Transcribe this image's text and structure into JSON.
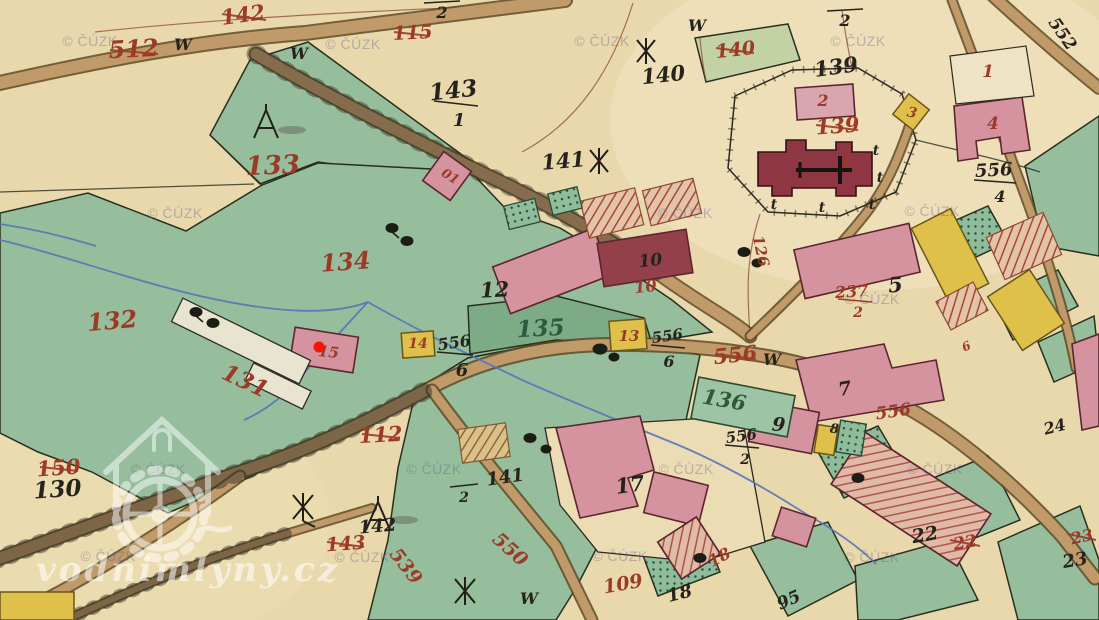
{
  "watermarks": {
    "cuzk": "© ČÚZK",
    "site": "vodnimlyny.cz"
  },
  "marker": {
    "color": "#ff1100",
    "meaning": "selected water mill location"
  },
  "palette": {
    "paper": "#e8d8ab",
    "meadow_green": "#96bd9c",
    "building_pink": "#d4939e",
    "building_yellow": "#dec04a",
    "church_red": "#8e3742",
    "road_tan": "#c09a69",
    "stream_blue": "#5377b8",
    "old_number_red": "#9c3a28",
    "number_black": "#26231c"
  },
  "labels": {
    "parcel_512": "512",
    "parcel_142_old": "142",
    "parcel_115": "115",
    "parcel_140_old": "140",
    "parcel_139_old": "139",
    "parcel_133": "133",
    "parcel_134": "134",
    "parcel_132": "132",
    "parcel_131": "131",
    "parcel_150": "150",
    "parcel_130": "130",
    "parcel_112": "112",
    "parcel_143_old": "143",
    "road_539": "539",
    "road_550": "550",
    "road_556_struck": "556",
    "parcel_556_red": "556",
    "parcel_109": "109",
    "house_18_red": "18",
    "parcel_22_red": "22",
    "parcel_23_red": "23",
    "frac_237_num": "237",
    "frac_237_den": "2",
    "parcel_126": "126",
    "house_10_red": "10",
    "house_01": "01",
    "house_1": "1",
    "house_2": "2",
    "house_3": "3",
    "house_4": "4",
    "house_13": "13",
    "house_14": "14",
    "house_15": "15",
    "church_1": "1",
    "small_6_red": "6",
    "frac_143_num": "143",
    "frac_143_den": "1",
    "parcel_140": "140",
    "parcel_141": "141",
    "parcel_139": "139",
    "parcel_12": "12",
    "parcel_135": "135",
    "parcel_136": "136",
    "parcel_5": "5",
    "house_7": "7",
    "house_9": "9",
    "house_8": "8",
    "house_10": "10",
    "parcel_17": "17",
    "parcel_18": "18",
    "parcel_22": "22",
    "parcel_23": "23",
    "parcel_24": "24",
    "parcel_95": "95",
    "parcel_142b": "142",
    "parcel_141b": "141",
    "frac_141_den": "2",
    "frac_top_den": "2",
    "road_552": "552",
    "frac_556_4_num": "556",
    "frac_556_4_den": "4",
    "frac_556_6a_num": "556",
    "frac_556_6a_den": "6",
    "frac_556_6b_num": "556",
    "frac_556_6b_den": "6",
    "frac_556_2_num": "556",
    "frac_556_2_den": "2",
    "letter_w": "W",
    "letter_t": "t"
  }
}
